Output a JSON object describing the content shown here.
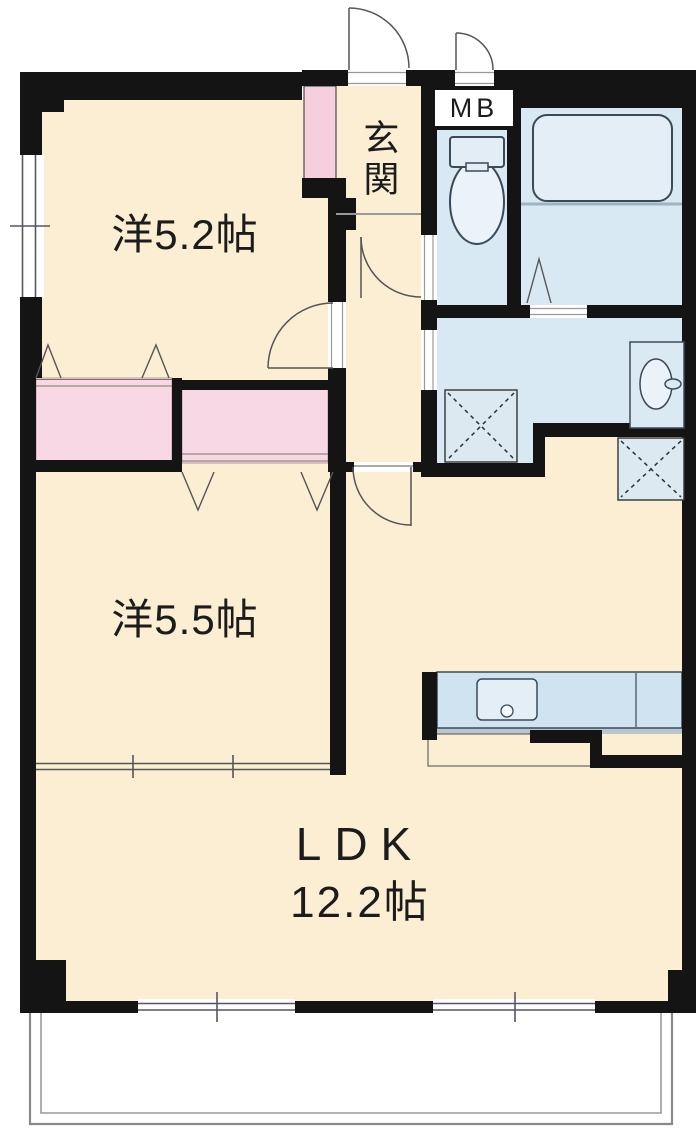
{
  "plan": {
    "title": "2LDK apartment floor plan",
    "rooms": {
      "western_5_2": {
        "label": "洋5.2帖"
      },
      "western_5_5": {
        "label": "洋5.5帖"
      },
      "genkan": {
        "label": "玄関"
      },
      "meter_box": {
        "label": "MB"
      },
      "ldk": {
        "label": "LDK",
        "size_label": "12.2帖"
      }
    },
    "colors": {
      "floor_cream": "#fbeed3",
      "closet_pink": "#f8d8e4",
      "closet_strip_pink": "#f6cfdf",
      "wet_area_blue": "#d9e9f4",
      "counter_blue": "#cfe3f0",
      "appliance_box_blue": "#dce9f0",
      "wall_black": "#141414",
      "door_line_gray": "#555555",
      "balcony_line_gray": "#8a8a8a",
      "fixture_outline": "#3a4a58",
      "text": "#1c1c1c"
    }
  }
}
